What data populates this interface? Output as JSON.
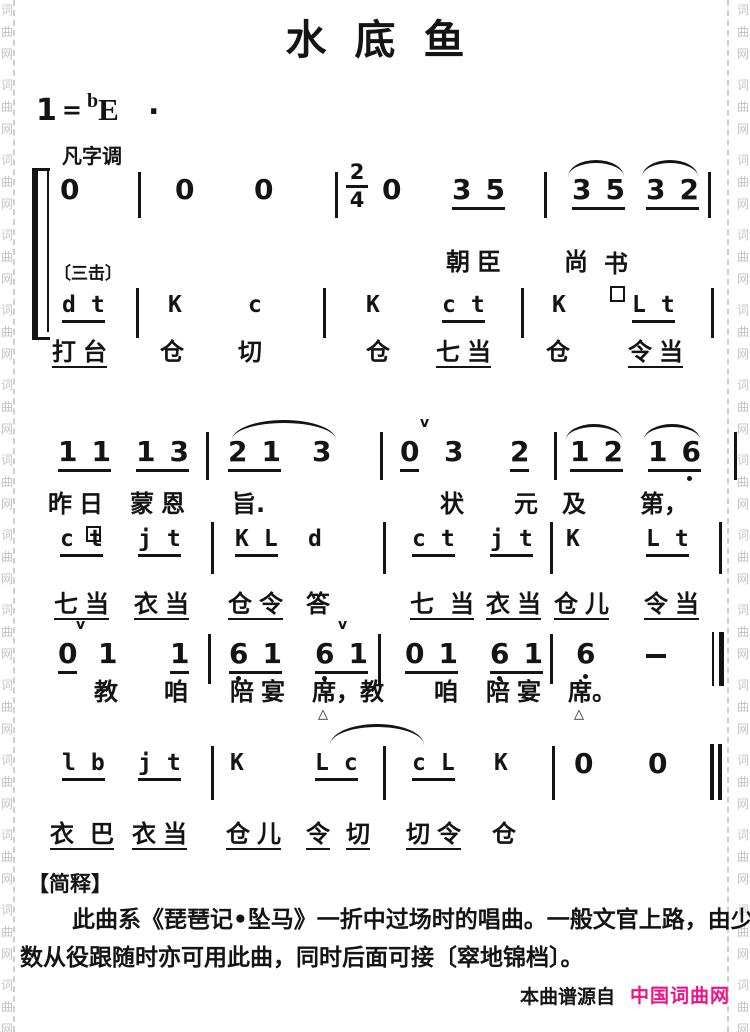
{
  "watermark": {
    "text": "词曲网"
  },
  "title": "水底鱼",
  "key": {
    "tonic": "1",
    "equals": "=",
    "accidental": "b",
    "note": "E",
    "dot": "."
  },
  "mode_label": "凡字调",
  "gong_label": "〔三击〕",
  "time_signature": {
    "top": "2",
    "bottom": "4"
  },
  "marks": {
    "breath": "v",
    "pause": "△"
  },
  "melody1": {
    "notes": [
      "0",
      "0",
      "0",
      "0",
      "35",
      "35",
      "32"
    ],
    "lyrics": [
      "朝臣",
      "尚",
      "书"
    ]
  },
  "perc1": {
    "letters": [
      "dt",
      "K",
      "c",
      "K",
      "ct",
      "K",
      "Lt"
    ],
    "lyrics": [
      "打台",
      "仓",
      "切",
      "仓",
      "七当",
      "仓",
      "令当"
    ]
  },
  "melody2": {
    "notes": [
      "11",
      "13",
      "21",
      "3",
      "0",
      "3",
      "2",
      "12",
      "16"
    ],
    "lyrics": [
      "昨日",
      "蒙恩",
      "旨.",
      "状",
      "元",
      "及",
      "第，"
    ]
  },
  "perc2": {
    "letters": [
      "ct",
      "jt",
      "KL",
      "d",
      "ct",
      "jt",
      "K",
      "Lt"
    ],
    "lyrics": [
      "七当",
      "衣当",
      "仓令",
      "答",
      "七当",
      "衣当",
      "仓儿",
      "令当"
    ]
  },
  "melody3": {
    "notes": [
      "0",
      "1",
      "1",
      "61",
      "61",
      "01",
      "61",
      "6"
    ],
    "lyrics": [
      "教",
      "咱",
      "陪宴",
      "席，教",
      "咱",
      "陪宴",
      "席。"
    ]
  },
  "perc3": {
    "letters": [
      "lb",
      "jt",
      "K",
      "Lc",
      "cL",
      "K",
      "0",
      "0"
    ],
    "lyrics": [
      "衣巴",
      "衣当",
      "仓儿",
      "令",
      "切",
      "切令",
      "仓"
    ]
  },
  "footnote": {
    "header": "【简释】",
    "line1": "此曲系《琵琶记•坠马》一折中过场时的唱曲。一般文官上路，由少",
    "line2": "数从役跟随时亦可用此曲，同时后面可接〔窣地锦档〕。",
    "credit_prefix": "本曲谱源自",
    "credit_site": "中国词曲网"
  },
  "colors": {
    "credit": "#ec1487",
    "ink": "#141414",
    "watermark": "#c3c3c3"
  }
}
